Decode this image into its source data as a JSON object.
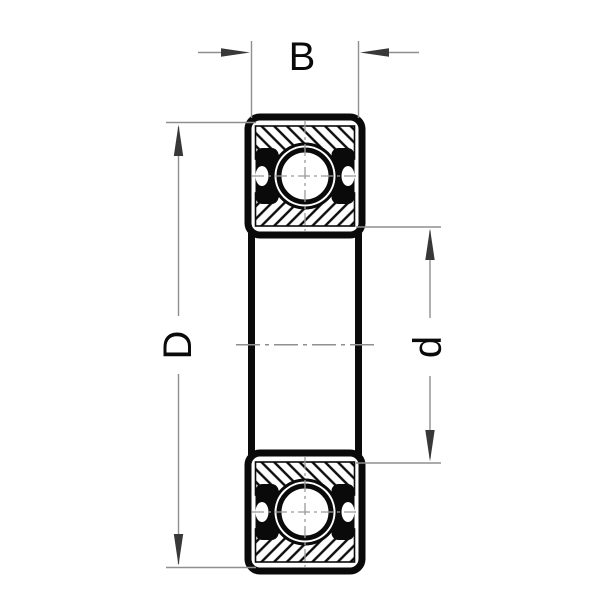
{
  "colors": {
    "ink": "#0a0a0a",
    "dimension": "#8f8f8f",
    "arrow": "#383838",
    "background": "#ffffff"
  },
  "dimensions": {
    "width_label": "B",
    "outer_diameter_label": "D",
    "bore_diameter_label": "d"
  }
}
